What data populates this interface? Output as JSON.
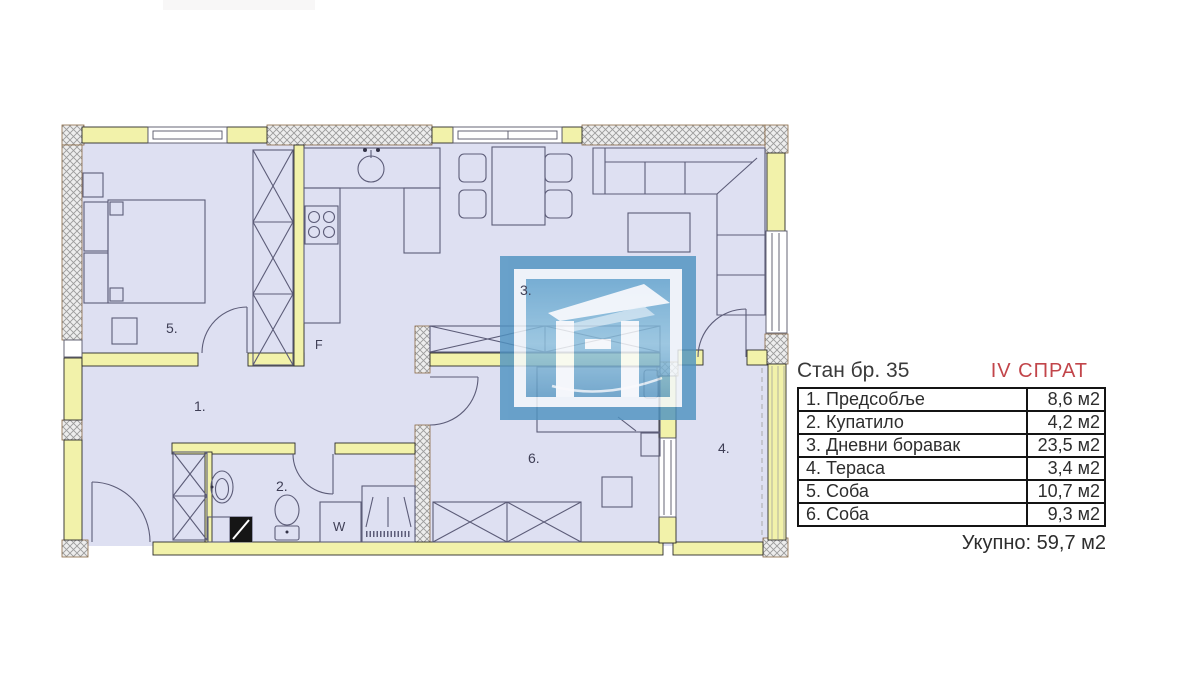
{
  "panel": {
    "title": "Стан бр. 35",
    "floor": "IV СПРАТ",
    "floor_color": "#c2454a",
    "rows": [
      {
        "name": "1. Предсобље",
        "area": "8,6 м2"
      },
      {
        "name": "2. Купатило",
        "area": "4,2 м2"
      },
      {
        "name": "3. Дневни боравак",
        "area": "23,5 м2"
      },
      {
        "name": "4. Тераса",
        "area": "3,4 м2"
      },
      {
        "name": "5. Соба",
        "area": "10,7 м2"
      },
      {
        "name": "6. Соба",
        "area": "9,3 м2"
      }
    ],
    "total": "Укупно: 59,7 м2"
  },
  "plan": {
    "room_labels": {
      "hall": "1.",
      "bath": "2.",
      "living": "3.",
      "terrace": "4.",
      "bedroom": "5.",
      "room6": "6."
    },
    "fixture_labels": {
      "fridge": "F",
      "washer": "W"
    },
    "colors": {
      "wall_yellow": "#f2f2aa",
      "floor": "#dee0f2",
      "line": "#5c5c78",
      "watermark_blue": "#4f93c1"
    }
  }
}
